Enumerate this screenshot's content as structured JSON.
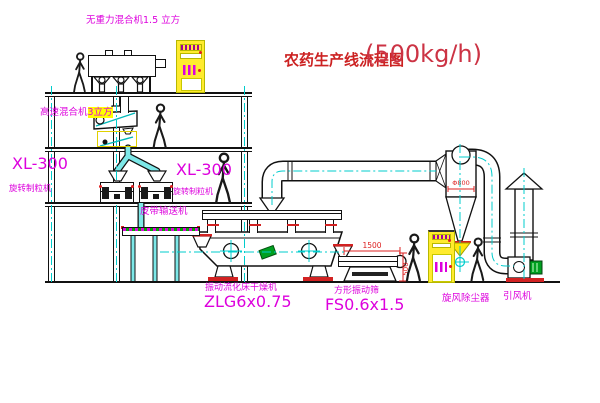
{
  "title": {
    "text": "农药生产线流程图",
    "capacity": "(500kg/h)"
  },
  "equipment": {
    "top_mixer": {
      "label": "无重力混合机1.5 立方"
    },
    "high_speed_mixer": {
      "name": "高速混合机",
      "size": "3立方"
    },
    "granulator_left": {
      "model": "XL-300",
      "name": "旋转制粒机"
    },
    "granulator_right": {
      "model": "XL-300",
      "name": "旋转制粒机"
    },
    "belt_conveyor": {
      "label": "皮带输送机"
    },
    "fluid_bed_dryer": {
      "name": "振动流化床干燥机",
      "model": "ZLG6x0.75"
    },
    "vibrating_screen": {
      "name": "方形振动筛",
      "model": "FS0.6x1.5",
      "dim_length": "1500",
      "dim_height": "500"
    },
    "cyclone": {
      "label": "旋风除尘器",
      "dim": "Φ800"
    },
    "fan": {
      "label": "引风机"
    }
  },
  "colors": {
    "label_magenta": "#dd00dd",
    "title_red": "#cc2222",
    "centerline_cyan": "#00cccc",
    "pipe_fill_cyan": "#7de8e8",
    "dimension_red": "#dd2222",
    "highlight_yellow": "#ffff00",
    "cabinet_yellow": "#ffeb2e",
    "motor_green": "#00a020"
  }
}
